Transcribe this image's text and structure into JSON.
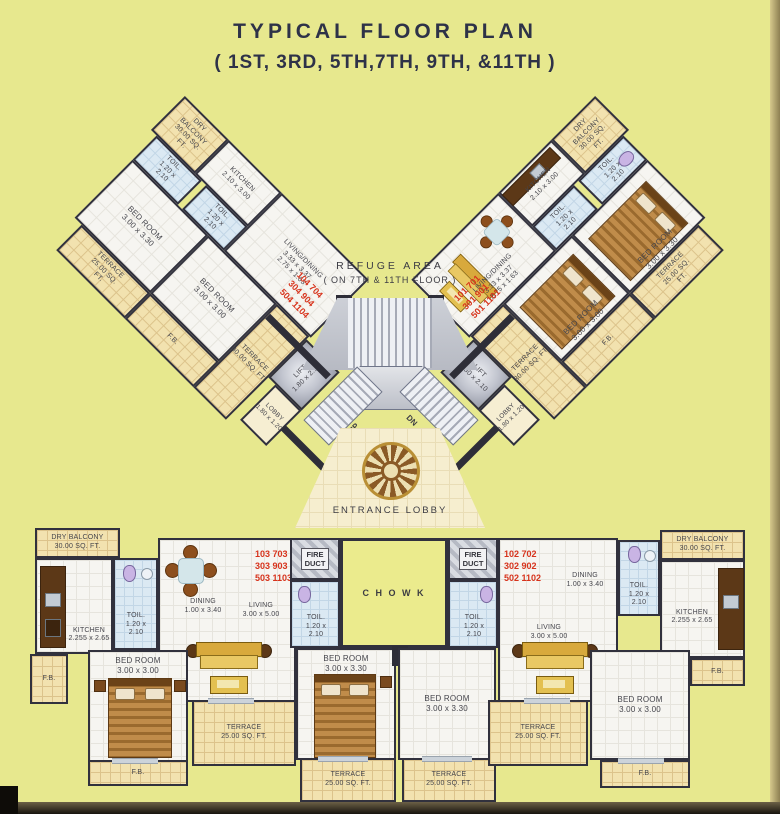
{
  "title": {
    "line1": "TYPICAL  FLOOR  PLAN",
    "line2": "( 1ST, 3RD, 5TH,7TH, 9TH, &11TH )"
  },
  "refuge": {
    "line1": "REFUGE AREA",
    "line2": "( ON 7TH & 11TH FLOOR )"
  },
  "stairs": {
    "up": "UP",
    "dn": "DN"
  },
  "entrance": {
    "label": "ENTRANCE LOBBY"
  },
  "rooms": {
    "terrace25": "TERRACE\n25.00 SQ. FT.",
    "terrace30": "TERRACE\n30.00 SQ. FT.",
    "dry_balcony": "DRY BALCONY\n30.00 SQ. FT.",
    "bedroom330": "BED ROOM\n3.00 x 3.30",
    "bedroom300": "BED ROOM\n3.00 x 3.00",
    "toilet": "TOIL.\n1.20 x\n2.10",
    "kitchen_wing": "KITCHEN\n2.10 x 3.00",
    "kitchen_flat": "KITCHEN\n2.255 x 2.65",
    "living_dining": "LIVING/DINING\n3.33 x 3.37\n2.75 x 1.63",
    "lobby": "LOBBY\n1.80 x 1.20",
    "lift": "LIFT\n1.80 x 2.10",
    "fb": "F.B.",
    "dining": "DINING\n1.00 x 3.40",
    "living": "LIVING\n3.00 x 5.00",
    "fire_duct": "FIRE\nDUCT",
    "chowk": "C H O W K"
  },
  "units": {
    "left_wing": "104  704\n304  904\n504 1104",
    "right_wing": "101  701\n301  901\n501 1101",
    "bottom_left": "103  703\n303  903\n503 1103",
    "bottom_right": "102  702\n302  902\n502 1102"
  },
  "colors": {
    "background": "#e7e88e",
    "wall": "#31313d",
    "terrace_fill": "#f2e2af",
    "floor_fill": "#f6f5f1",
    "bath_fill": "#dbe9f3",
    "unit_number_red": "#d7331c",
    "title_text": "#2e3248"
  }
}
